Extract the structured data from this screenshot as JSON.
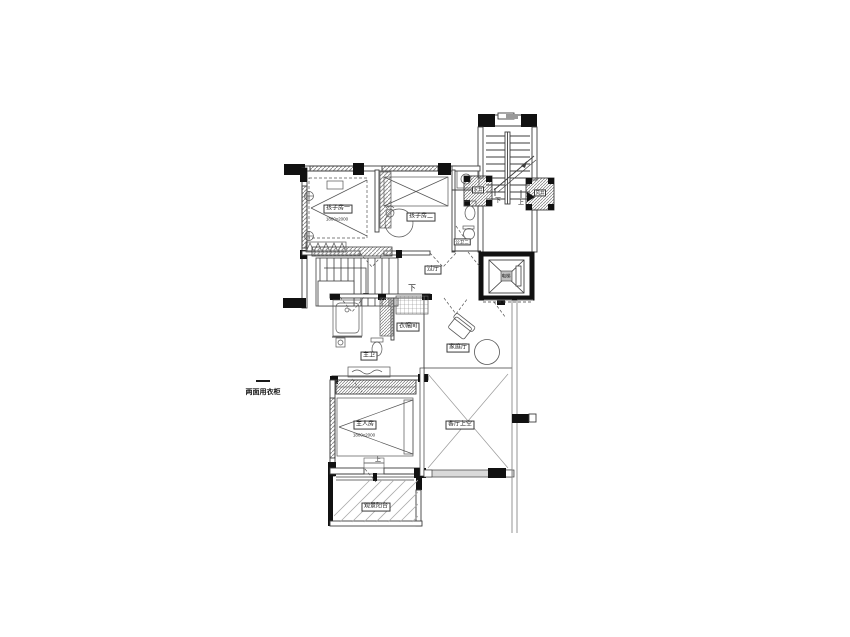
{
  "drawing": {
    "kind": "residential floor plan (upper level of duplex)",
    "colors": {
      "background": "#ffffff",
      "line": "#3d3d3d",
      "wall_fill": "#111111",
      "window_hatch": "#8f8f8f",
      "void_line": "#999999"
    }
  },
  "labels": {
    "kids_room_1": "孩子房一",
    "kids_room_1_dim": "1800x2000",
    "kids_room_2": "孩子房二",
    "public_bath_2": "公卫二",
    "shaft_left": "水井",
    "shaft_right": "风井",
    "hallway": "过厅",
    "stair_core_down": "下",
    "stair_core_up": "上",
    "inner_stair_down": "下",
    "cloakroom": "衣帽间",
    "master_bath": "主卫",
    "family_hall": "家庭厅",
    "elevator": "电梯",
    "living_room_void": "客厅上空",
    "master_bedroom": "主人房",
    "master_bedroom_dim": "1800x2000",
    "wardrobe_note": "两面用衣柜",
    "balcony": "观景阳台",
    "balcony_step_up": "上"
  }
}
